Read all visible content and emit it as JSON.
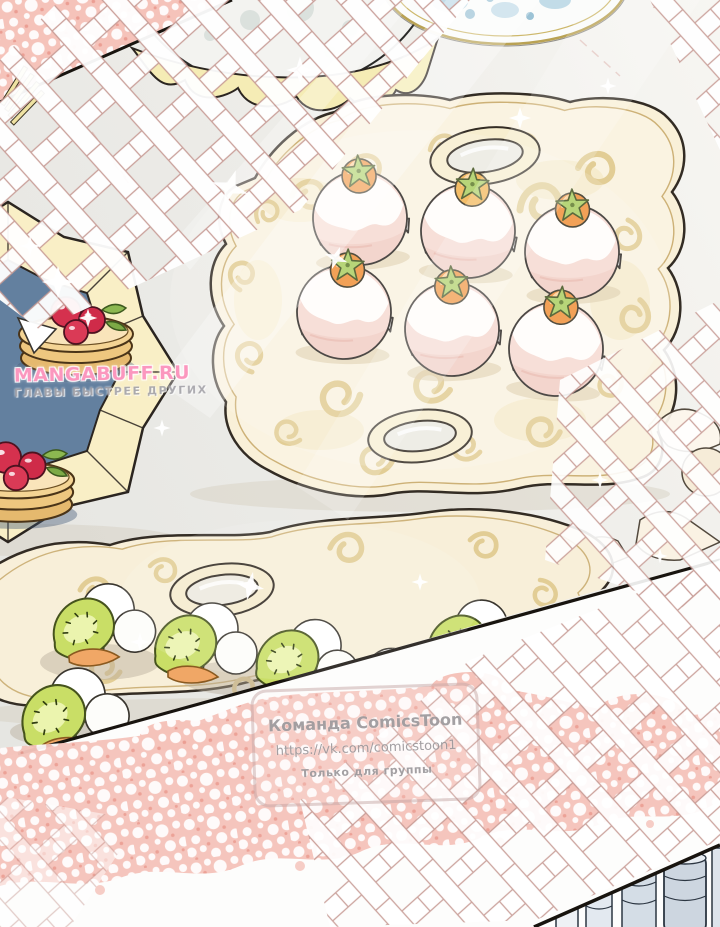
{
  "panel": {
    "type": "webtoon_panel",
    "colors": {
      "lace_pink": "#f5c3ba",
      "tray_cream": "#f9f0d8",
      "tray_gold": "#e2cd95",
      "fruit_orange": "#f0913a",
      "fruit_orange_light": "#f2b24d",
      "leaf_green": "#abce62",
      "kiwi_green": "#c9de66",
      "cherry_red": "#d5314e",
      "plate_blue": "#63809f",
      "panel_border": "#18140f"
    },
    "scene": {
      "cream_puff_count": 6,
      "kiwi_canape_count": 6,
      "pancake_stack_count": 2
    }
  },
  "watermarks": {
    "site": {
      "name": "MANGABUFF.RU",
      "tagline": "ГЛАВЫ БЫСТРЕЕ ДРУГИХ"
    },
    "team": {
      "title": "Команда ComicsToon",
      "url": "https://vk.com/comicstoon1",
      "note": "Только для группы"
    }
  }
}
